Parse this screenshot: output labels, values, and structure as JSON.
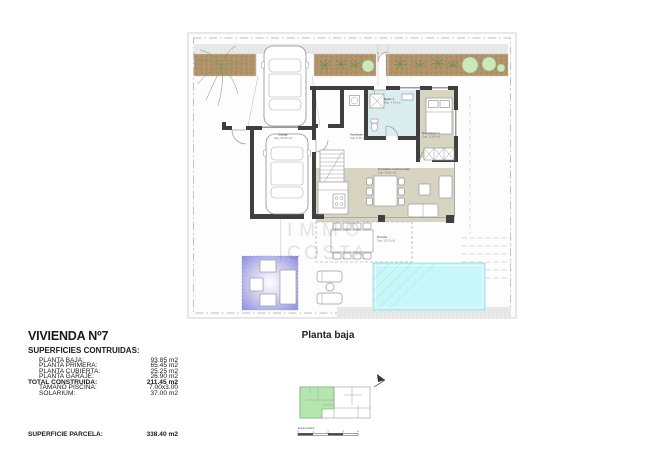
{
  "title_block": {
    "title": "VIVIENDA Nº7",
    "section_heading": "SUPERFICIES CONTRUIDAS:",
    "rows": [
      {
        "label": "PLANTA BAJA:",
        "value": "93.85 m2"
      },
      {
        "label": "PLANTA PRIMERA:",
        "value": "65.45 m2"
      },
      {
        "label": "PLANTA CUBIERTA:",
        "value": "25.25 m2"
      },
      {
        "label": "PLANTA GARAJE:",
        "value": "26.90 m2"
      }
    ],
    "total": {
      "label": "TOTAL CONSTRUIDA:",
      "value": "211.45 m2"
    },
    "extras": [
      {
        "label": "TAMAÑO PISCINA:",
        "value": "7.00x3.00"
      },
      {
        "label": "SOLARIUM:",
        "value": "37.00 m2"
      }
    ],
    "parcel": {
      "label": "SUPERFICIE PARCELA:",
      "value": "338.40 m2"
    }
  },
  "plan": {
    "caption": "Planta baja",
    "watermark": {
      "line1": "IMMO",
      "line2": "COSTA"
    },
    "room_labels": {
      "garaje": {
        "name": "Garaje",
        "area": "Sup: 26.90 m2"
      },
      "vestibulo": {
        "name": "Vestíbulo",
        "area": "Sup: 8.40 m2"
      },
      "bano": {
        "name": "Baño 1",
        "area": "Sup: 4.70 m2"
      },
      "dormitorio": {
        "name": "Dormitorio 1",
        "area": "Sup: 11.80 m2"
      },
      "salon": {
        "name": "Comedor-cocina-estar",
        "area": "Sup: 35.80 m2"
      },
      "porche": {
        "name": "Porche",
        "area": "Sup: 18.20 m2"
      }
    },
    "colors": {
      "wall": "#3f3f3f",
      "room_beige": "#d8d4c2",
      "bath_blue": "#dcedf0",
      "pool_fill": "#c9f6f8",
      "pool_edge": "#93d8dc",
      "planter_brown": "#b2946a",
      "plant_green": "#8fbc7f",
      "lounge_purple": "#8b8bdc",
      "keyplan_green": "#b5e6b0"
    }
  },
  "key_plan": {
    "scale_label": "Escala Gráfica",
    "ticks": [
      "0",
      "1",
      "2",
      "3",
      "4"
    ]
  }
}
